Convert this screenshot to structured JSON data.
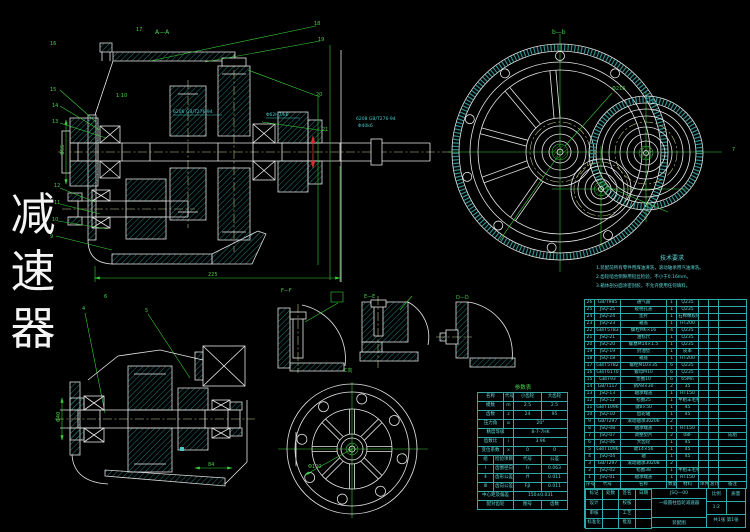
{
  "side_title": {
    "chars": [
      "减",
      "速",
      "器"
    ]
  },
  "view_labels": {
    "section_aa": "A—A",
    "view_bb": "b—b",
    "detail_ff": "F—F",
    "detail_ee": "E—E",
    "detail_dd": "D—D",
    "view_c": "C向",
    "param_title": "参数表"
  },
  "annotations": {
    "c1": "6206 GB/T276-94",
    "c2": "Φ62H7/k6",
    "c3": "6208 GB/T276-94",
    "c4": "Φ40k6",
    "housing_note": "1:10",
    "dims": {
      "main_width": "225",
      "main_shaft": "Φ55",
      "lower_shaft": "Φ40",
      "coupling_len": "84",
      "flange_bore": "Φ100",
      "end_dia": "Φ216"
    }
  },
  "balloons": {
    "b1": "16",
    "b2": "15",
    "b3": "14",
    "b4": "13",
    "b5": "12",
    "b6": "11",
    "b7": "10",
    "b8": "9",
    "b9": "17",
    "b10": "18",
    "b11": "19",
    "b12": "20",
    "b13": "21",
    "b14": "7",
    "b15": "4",
    "b16": "5",
    "b17": "6"
  },
  "tech_req": {
    "heading": "技术要求",
    "lines": [
      "1.装配前所有零件用煤油清洗，滚动轴承用汽油清洗。",
      "2.齿轮啮合侧隙用铅丝检验，不小于0.16mm。",
      "3.箱体剖分面涂密封胶，不允许使用任何填料。"
    ]
  },
  "param_table": {
    "rows": [
      [
        {
          "t": "名称",
          "s": 2
        },
        {
          "t": "代号",
          "s": 1
        },
        {
          "t": "小齿轮",
          "s": 2
        },
        {
          "t": "大齿轮",
          "s": 2
        }
      ],
      [
        {
          "t": "模数",
          "s": 2
        },
        "m",
        {
          "t": "2.5",
          "s": 2
        },
        {
          "t": "2.5",
          "s": 2
        }
      ],
      [
        {
          "t": "齿数",
          "s": 2
        },
        "z",
        {
          "t": "24",
          "s": 2
        },
        {
          "t": "95",
          "s": 2
        }
      ],
      [
        {
          "t": "压力角",
          "s": 2
        },
        "α",
        {
          "t": "20°",
          "s": 4
        }
      ],
      [
        {
          "t": "精度等级",
          "s": 3
        },
        {
          "t": "8-7-7HK",
          "s": 4
        }
      ],
      [
        {
          "t": "齿数比",
          "s": 2
        },
        "i",
        {
          "t": "3.96",
          "s": 4
        }
      ],
      [
        {
          "t": "变位系数",
          "s": 2
        },
        "x",
        {
          "t": "0",
          "s": 2
        },
        {
          "t": "0",
          "s": 2
        }
      ],
      [
        "组",
        {
          "t": "检验项目",
          "s": 2
        },
        {
          "t": "代号",
          "s": 2
        },
        {
          "t": "公差",
          "s": 2
        }
      ],
      [
        "Ⅰ",
        {
          "t": "齿圈径向跳动",
          "s": 2
        },
        {
          "t": "Fr",
          "s": 2
        },
        {
          "t": "0.063",
          "s": 2
        }
      ],
      [
        "Ⅱ",
        {
          "t": "齿形公差",
          "s": 2
        },
        {
          "t": "ff",
          "s": 2
        },
        {
          "t": "0.011",
          "s": 2
        }
      ],
      [
        "Ⅲ",
        {
          "t": "齿向公差",
          "s": 2
        },
        {
          "t": "Fβ",
          "s": 2
        },
        {
          "t": "0.011",
          "s": 2
        }
      ],
      [
        {
          "t": "中心距及偏差",
          "s": 3
        },
        {
          "t": "150±0.031",
          "s": 4
        }
      ],
      [
        {
          "t": "配对齿轮",
          "s": 3
        },
        {
          "t": "图号",
          "s": 2
        },
        {
          "t": "齿数",
          "s": 2
        }
      ]
    ]
  },
  "bom": {
    "rows": [
      [
        "26",
        "GB/T985",
        "通气器",
        "1",
        "Q235",
        "",
        "",
        ""
      ],
      [
        "25",
        "JSQ-25",
        "窥视孔盖",
        "1",
        "Q235",
        "",
        "",
        ""
      ],
      [
        "24",
        "JSQ-24",
        "垫片",
        "1",
        "石棉橡胶纸",
        "",
        "",
        ""
      ],
      [
        "23",
        "JSQ-23",
        "箱盖",
        "1",
        "HT200",
        "",
        "",
        ""
      ],
      [
        "22",
        "GB/T5783",
        "螺栓M6×16",
        "4",
        "Q235",
        "",
        "",
        ""
      ],
      [
        "21",
        "JSQ-21",
        "油标尺",
        "1",
        "Q235",
        "",
        "",
        ""
      ],
      [
        "20",
        "JSQ-20",
        "螺塞M14×1.5",
        "1",
        "Q235",
        "",
        "",
        ""
      ],
      [
        "19",
        "JSQ-19",
        "封油垫",
        "1",
        "皮革",
        "",
        "",
        ""
      ],
      [
        "18",
        "JSQ-18",
        "箱座",
        "1",
        "HT200",
        "",
        "",
        ""
      ],
      [
        "17",
        "GB/T5782",
        "螺栓M10×35",
        "6",
        "Q235",
        "",
        "",
        ""
      ],
      [
        "16",
        "GB/T6170",
        "螺母M10",
        "6",
        "Q235",
        "",
        "",
        ""
      ],
      [
        "15",
        "GB/T93",
        "垫圈10",
        "6",
        "65Mn",
        "",
        "",
        ""
      ],
      [
        "14",
        "GB/T117",
        "销A8×30",
        "2",
        "35",
        "",
        "",
        ""
      ],
      [
        "13",
        "JSQ-13",
        "轴承端盖",
        "1",
        "HT150",
        "",
        "",
        ""
      ],
      [
        "12",
        "JSQ-12",
        "毡圈25",
        "1",
        "半粗羊毛毡",
        "",
        "",
        ""
      ],
      [
        "11",
        "GB/T1096",
        "键8×50",
        "1",
        "45",
        "",
        "",
        ""
      ],
      [
        "10",
        "JSQ-10",
        "齿轮轴",
        "1",
        "45",
        "",
        "",
        ""
      ],
      [
        "9",
        "GB/T297",
        "滚动轴承30206",
        "2",
        "",
        "",
        "",
        ""
      ],
      [
        "8",
        "JSQ-08",
        "轴承端盖",
        "1",
        "HT150",
        "",
        "",
        ""
      ],
      [
        "7",
        "JSQ-07",
        "调整垫片",
        "2",
        "08F",
        "",
        "",
        "成组"
      ],
      [
        "6",
        "JSQ-06",
        "大齿轮",
        "1",
        "45",
        "",
        "",
        ""
      ],
      [
        "5",
        "GB/T1096",
        "键14×56",
        "1",
        "45",
        "",
        "",
        ""
      ],
      [
        "4",
        "JSQ-04",
        "轴",
        "1",
        "45",
        "",
        "",
        ""
      ],
      [
        "3",
        "GB/T297",
        "滚动轴承30208",
        "2",
        "",
        "",
        "",
        ""
      ],
      [
        "2",
        "JSQ-02",
        "毡圈38",
        "1",
        "半粗羊毛毡",
        "",
        "",
        ""
      ],
      [
        "1",
        "JSQ-01",
        "轴承端盖",
        "1",
        "HT150",
        "",
        "",
        ""
      ],
      [
        "序号",
        "代号",
        "名称",
        "数量",
        "材料",
        "单件",
        "总计",
        "备注"
      ]
    ]
  },
  "title_block": {
    "left_rows": [
      [
        "标记",
        "处数",
        "签名",
        "日期"
      ],
      [
        "设计",
        "",
        "校核",
        ""
      ],
      [
        "审核",
        "",
        "工艺",
        ""
      ],
      [
        "标准化",
        "",
        "批准",
        ""
      ]
    ],
    "drawing_no": "JSQ—00",
    "title": "一级圆柱齿轮减速器",
    "subtitle": "装配图",
    "scale_label": "比例",
    "scale": "1:2",
    "mass_label": "质量",
    "sheet": "共1张 第1张"
  }
}
